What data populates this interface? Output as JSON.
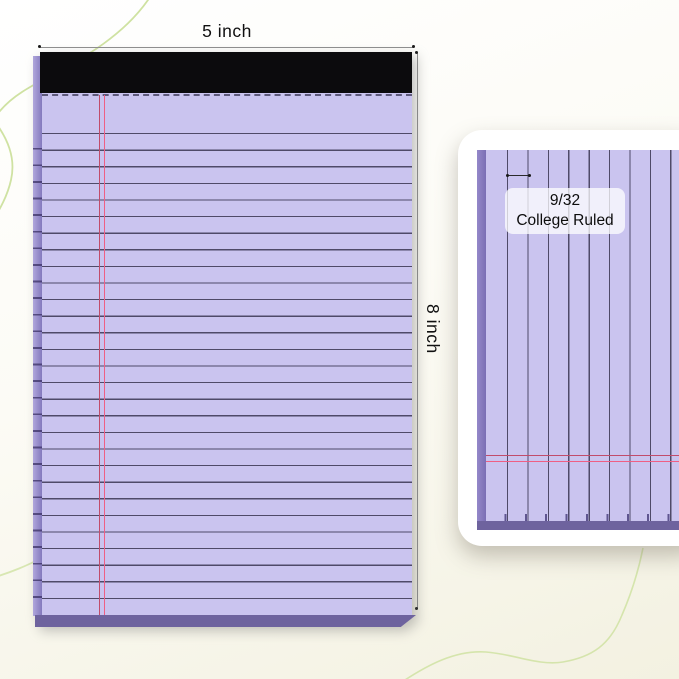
{
  "product_image": {
    "width_annotation": "5 inch",
    "height_annotation": "8 inch",
    "ruling_spec": {
      "spacing": "9/32",
      "type": "College Ruled"
    }
  },
  "colors": {
    "paper": "#cac4ef",
    "rule_line": "#4f4a68",
    "margin_red_dark": "#c14c6b",
    "margin_red_bright": "#ef5f84",
    "binding": "#0c0b0d",
    "side_edge": "#b0a7dc",
    "side_edge_dark": "#8479bd",
    "pad_bottom": "#6e639e",
    "dim_line": "#8f8f8f",
    "dim_text": "#111111",
    "curve": "#cfe2a2",
    "card": "#ffffff"
  }
}
